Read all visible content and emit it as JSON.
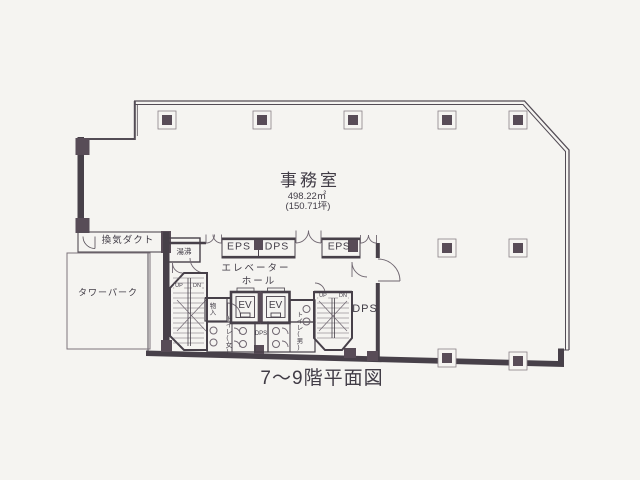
{
  "caption": "7〜9階平面図",
  "office": {
    "name": "事務室",
    "area_m2": "498.22㎡",
    "area_tsubo": "(150.71坪)"
  },
  "rooms": {
    "vent_duct": "換気ダクト",
    "tower_park": "タワーパーク",
    "hot_water": "湯沸",
    "eps1": "EPS",
    "dps1": "DPS",
    "eps2": "EPS",
    "elevator_hall_line1": "エレベーター",
    "elevator_hall_line2": "ホール",
    "ev1": "EV",
    "ev2": "EV",
    "storage": "物入",
    "toilet_women": "トイレ(女)",
    "toilet_men": "トイレ(男)",
    "dps_small": "DPS",
    "dps_room": "DPS"
  },
  "stairs": {
    "left_up": "UP",
    "left_dn": "DN",
    "right_up": "UP",
    "right_dn": "DN"
  },
  "colors": {
    "wall": "#474049",
    "column": "#584c57",
    "paper": "#f5f4f1",
    "thin_line": "#6f6670"
  }
}
